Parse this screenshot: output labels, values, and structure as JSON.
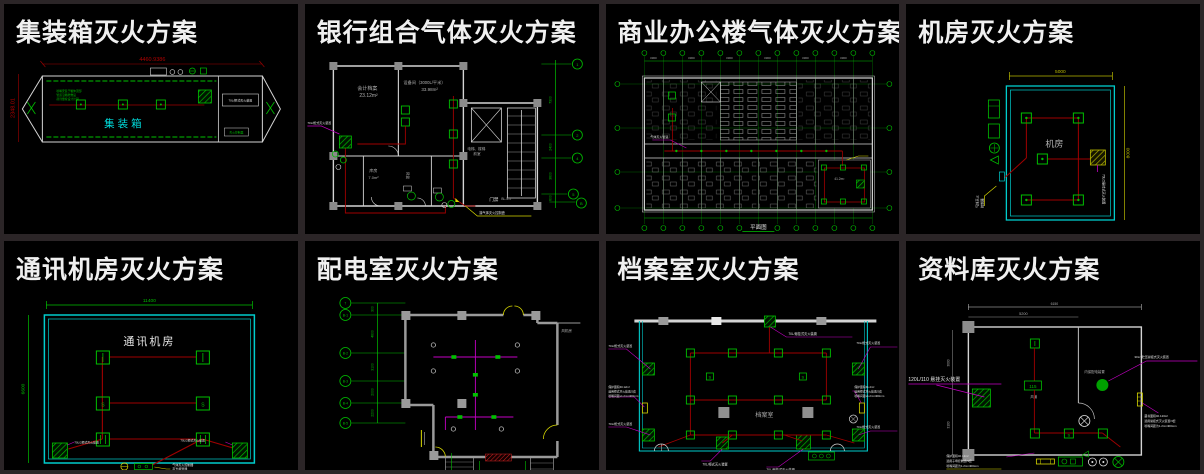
{
  "window": {
    "background": "#2b2527",
    "panel_background": "#000000"
  },
  "colors": {
    "cad_green": "#00bf00",
    "cad_cyan": "#00cccc",
    "cad_red": "#a00000",
    "cad_magenta": "#c400c4",
    "cad_yellow": "#d8d800",
    "wall_gray": "#d4d4d4"
  },
  "panels": [
    {
      "title": "集装箱灭火方案",
      "room": "集装箱",
      "dim_top": "4460.9386",
      "dim_left": "2348.01",
      "device_label": "70L/柜式灭火装置",
      "ctrl_label": "灭火控制器",
      "note_lines": [
        "喷嘴安装于箱体顶部",
        "管道沿箱壁敷设",
        "药剂量按设计计算"
      ]
    },
    {
      "title": "银行组合气体灭火方案",
      "rooms": [
        {
          "name": "会计档案",
          "area": "23.12m²"
        },
        {
          "name": "设备间（3000L/平米）",
          "area": "33.98m²"
        },
        {
          "name": "库房",
          "area": "7.0m²"
        }
      ],
      "stair_label": "BL-5-1",
      "lobby_lines": [
        "电梯、楼梯",
        "前室"
      ],
      "door_label": "门禁",
      "duct_label": "风管",
      "cabinet_label": "70L/柜式灭火装置",
      "controller_label": "接气体灭火控制盘",
      "axes": [
        "1",
        "2",
        "4",
        "5",
        "B"
      ],
      "axis_dims": [
        "7300",
        "2400",
        "3600",
        "600"
      ]
    },
    {
      "title": "商业办公楼气体灭火方案",
      "plan_label": "平面图",
      "tick_label": "3300",
      "pipe_label": "气体灭火管道",
      "room_area": "41.2m²"
    },
    {
      "title": "机房灭火方案",
      "room": "机房",
      "dim_top": "5000",
      "dim_right": "8000",
      "device_label": "70L/2悬挂式灭火装置",
      "controller_lines": [
        "气体灭火",
        "控制器"
      ]
    },
    {
      "title": "通讯机房灭火方案",
      "room": "通讯机房",
      "dim_top": "11400",
      "dim_left": "6600",
      "cabinet_left": "70L/2柜式灭火装置",
      "cabinet_right": "70L/2柜式灭火装置",
      "controller_lines": [
        "气体灭火控制器",
        "声光报警器"
      ]
    },
    {
      "title": "配电室灭火方案",
      "axes_left": [
        "7",
        "B-1",
        "B-2",
        "B-3",
        "B-4",
        "B-5"
      ],
      "dims_left": [
        "300",
        "4600",
        "3100",
        "2000",
        "2200"
      ],
      "dims_bottom": [
        "3000",
        "5400",
        "8400"
      ],
      "axes_bottom": [
        "1-4",
        "1-5",
        "1-6"
      ],
      "fan_room": "风机房"
    },
    {
      "title": "档案室灭火方案",
      "room": "档案室",
      "label_top": "70L/悬挂式灭火装置",
      "label_left_1": "70L/柜式灭火装置",
      "label_left_lines": [
        "保护面积40.12m²",
        "选用柜式灭火装置/2套",
        "喷嘴间距≤1.2m×400mm"
      ],
      "label_left_2": "70L/柜式灭火装置",
      "label_right_1": "70L/柜式灭火装置",
      "label_right_lines": [
        "保护面积41.2m²",
        "选用柜式灭火装置/2套",
        "喷嘴间距≤1.2m×400mm"
      ],
      "label_right_2": "70L/柜式灭火装置",
      "label_bottom_1": "70L/柜式灭火装置",
      "label_bottom_2": "70L/悬挂式灭火装置"
    },
    {
      "title": "资料库灭火方案",
      "main_label": "120L/110 悬挂灭火装置",
      "hang_label": "30L/1贮压悬挂式灭火装置",
      "box_label": "内保配电装置",
      "riser_label": "115",
      "duct_label": "风道",
      "dim_top_outer": "6150",
      "dim_top_inner": "5200",
      "dim_left_1": "3000",
      "dim_left_2": "3100",
      "right_lines": [
        "藏书面积40.123m²",
        "选用悬挂式灭火装置/3套",
        "喷嘴间距为1.2m×400mm"
      ],
      "bottom_lines": [
        "保护面积40.12m²",
        "选用子母控制盘/3套",
        "喷嘴间距为1.2m×400mm"
      ]
    }
  ]
}
